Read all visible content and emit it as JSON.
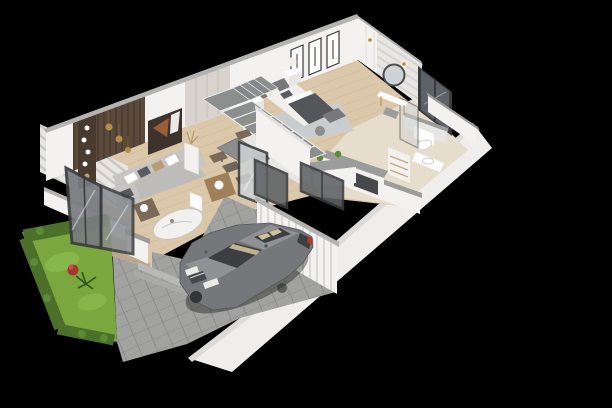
{
  "scene": {
    "title": "Isometric 3D floor plan render of a two-storey house ground floor",
    "type": "cutaway dollhouse architectural visualization",
    "background": "#000000",
    "no_visible_text": true
  },
  "palette": {
    "bg": "#000000",
    "wall_white": "#f3f2f0",
    "wall_shade": "#e7e6e3",
    "wall_cap": "#b3b3b1",
    "partition_cap": "#9c9c9a",
    "outer_wall": "#efeeec",
    "outer_wall_cap": "#dcdbd9",
    "wood_floor": "#dbc7a9",
    "tile_floor": "#e7ddcc",
    "pavers": "#a2a2a0",
    "pavers_line": "#8c8c8a",
    "lawn": "#7aa83e",
    "lawn_light": "#92c253",
    "hedge": "#4a7029",
    "hedge_light": "#5d8a36",
    "plant_red": "#a8342e",
    "accent_wood": "#5b4a3c",
    "accent_wood_dark": "#483a2e",
    "greige": "#d8d4cd",
    "art_dark": "#3e332c",
    "art_copper": "#9a5f38",
    "marble": "#f3f1ee",
    "marble_vein": "#c9c7c3",
    "sofa": "#c7c5c1",
    "sofa_dark": "#bebcb8",
    "pillow_dark": "#595b5e",
    "pillow_tan": "#b99c74",
    "table_gray": "#8b8d8c",
    "chair_brown": "#7a6a57",
    "chair_tan": "#a08058",
    "stair_tread": "#8d8f8e",
    "glass_dark": "#5e6266",
    "glass_light": "#ced3d6",
    "frame_dark": "#3a3c3e",
    "bed_blanket": "#54565a",
    "headboard": "#76787a",
    "rug": "#c8cdd0",
    "linen": "#f1efec",
    "gold": "#b08d4f",
    "counter_gray": "#9b9d9c",
    "appliance_dark": "#46484b",
    "cabinet_wood": "#c9a87c",
    "car_body": "#75777a",
    "car_roof": "#8f9194",
    "car_glass": "#3c3e41",
    "car_seat": "#d2bf9a",
    "car_light": "#eceae6",
    "car_tail": "#b33530",
    "white": "#fdfdfd",
    "step_light": "#b9b9b7",
    "step_dark": "#a9a9a7",
    "porch_edge": "#b8a88e"
  },
  "rooms": [
    {
      "name": "living-room",
      "objects": [
        "l-shaped-gray-sofa",
        "throw-pillows",
        "marble-coffee-table",
        "rattan-armchair",
        "tall-marble-pedestal-with-dried-plant",
        "gold-pendant-lights",
        "dark-wood-slat-accent-wall",
        "wall-shelf-with-white-vases",
        "abstract-wall-art",
        "glazed-patio-doors"
      ]
    },
    {
      "name": "dining-area",
      "objects": [
        "gray-dining-table",
        "five-upholstered-chairs",
        "tan-lounge-chair",
        "dark-framed-glass-partition",
        "white-decor-pedestal"
      ]
    },
    {
      "name": "kitchen",
      "objects": [
        "l-shaped-counter",
        "island-peninsula",
        "sink",
        "dark-oven",
        "tall-cabinet-with-wood-shelves",
        "potted-plants"
      ]
    },
    {
      "name": "staircase",
      "objects": [
        "l-shaped-stair",
        "gray-treads",
        "white-stringer-wall",
        "upper-landing"
      ]
    },
    {
      "name": "bedroom",
      "objects": [
        "double-bed-dark-blanket",
        "gray-headboard",
        "two-nightstands",
        "two-table-lamps",
        "light-gray-area-rug",
        "foot-bench",
        "pouf",
        "vanity-desk",
        "round-mirror",
        "stool",
        "white-wardrobe-panels",
        "three-framed-artworks",
        "wall-sconces",
        "chevron-accent-wall",
        "dark-glazed-balcony-door"
      ]
    },
    {
      "name": "bathroom",
      "objects": [
        "wall-hung-toilet",
        "vanity-with-basin",
        "shower-glass-panel",
        "half-height-plumbing-wall"
      ]
    },
    {
      "name": "garage",
      "objects": [
        "gray-sedan-car",
        "paver-floor",
        "white-slatted-wall",
        "dark-glass-doors-to-hallway"
      ]
    },
    {
      "name": "exterior",
      "objects": [
        "front-lawn",
        "trimmed-hedges",
        "red-flowering-plant",
        "small-palm",
        "gray-paver-driveway",
        "entry-steps",
        "wooden-porch",
        "low-garden-wall",
        "striped-cladding-facade",
        "tall-white-boundary-wall"
      ]
    }
  ]
}
